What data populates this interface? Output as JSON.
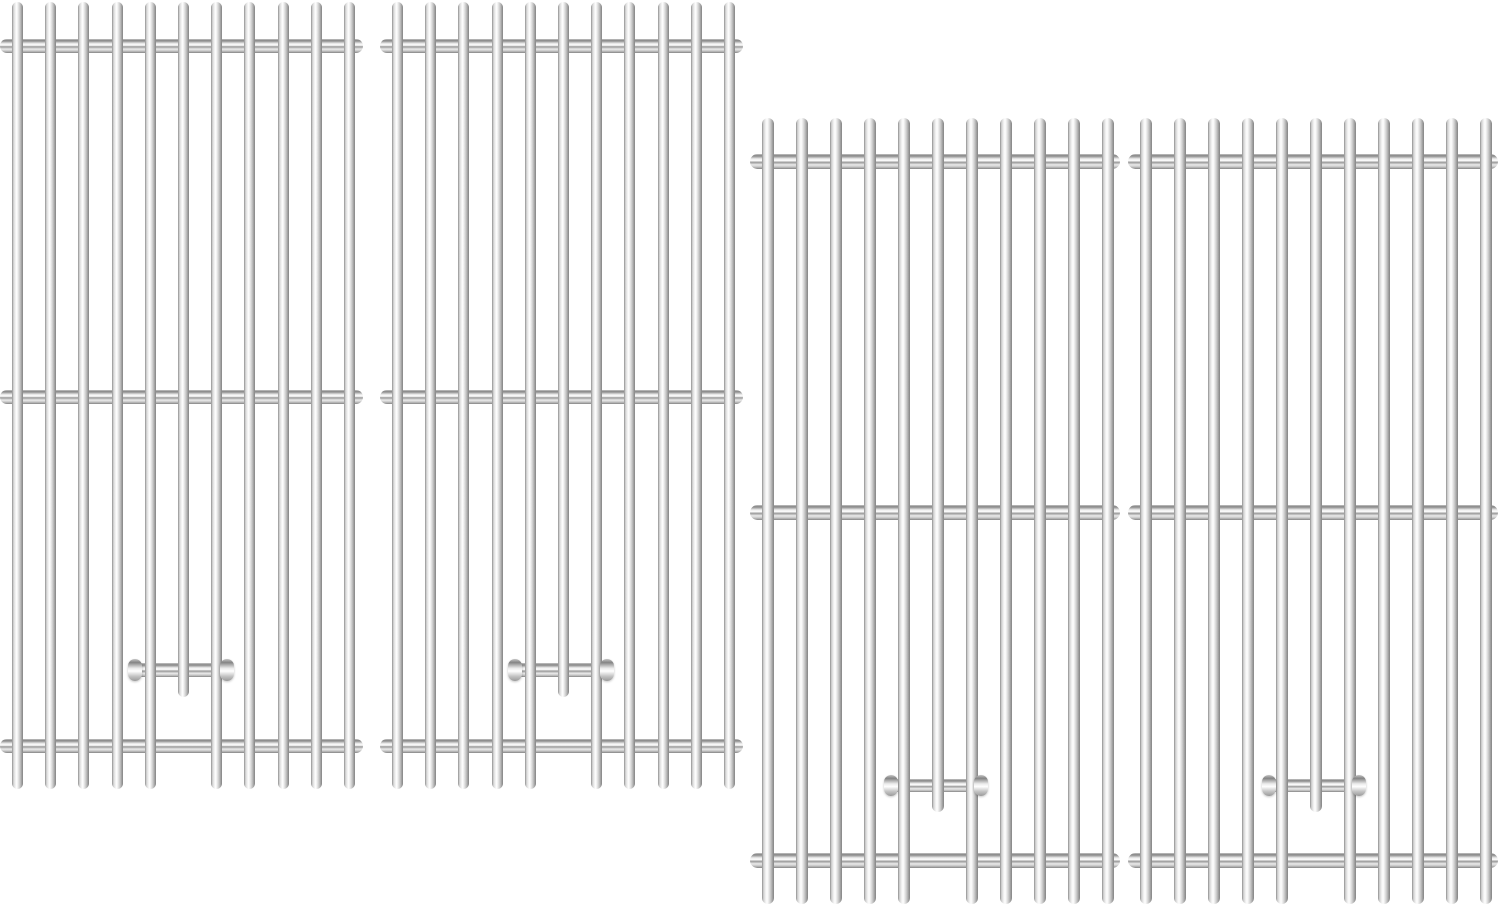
{
  "image": {
    "kind": "product-photo",
    "subject": "stainless-steel-grill-cooking-grates",
    "panel_count": 4,
    "rods_per_panel": 11,
    "support_rods_per_panel": 3,
    "brackets_per_panel": 1
  },
  "colors": {
    "background": "#ffffff",
    "metal_highlight": "#ffffff",
    "metal_light": "#ebebeb",
    "metal_mid": "#c4c4c4",
    "metal_dark": "#9a9a9a",
    "metal_edge": "#848484"
  },
  "panels": [
    {
      "x": 5,
      "y": 2,
      "barCount": 11,
      "barStart": 7,
      "barSpacing": 33.2,
      "barW": 11,
      "barH": 787,
      "shortIdx": 5,
      "shortH": 695,
      "crossbarYs": [
        37,
        388,
        737
      ],
      "cbH": 14,
      "cbX": -5,
      "cbW": 363,
      "bracket": {
        "x": 123,
        "w": 106,
        "rodY": 661,
        "rodH": 14,
        "capY": 657,
        "capH": 22,
        "capW": 14
      }
    },
    {
      "x": 385,
      "y": 2,
      "barCount": 11,
      "barStart": 7,
      "barSpacing": 33.2,
      "barW": 11,
      "barH": 787,
      "shortIdx": 5,
      "shortH": 695,
      "crossbarYs": [
        37,
        388,
        737
      ],
      "cbH": 14,
      "cbX": -5,
      "cbW": 363,
      "bracket": {
        "x": 123,
        "w": 106,
        "rodY": 661,
        "rodH": 14,
        "capY": 657,
        "capH": 22,
        "capW": 14
      }
    },
    {
      "x": 756,
      "y": 118,
      "barCount": 11,
      "barStart": 6,
      "barSpacing": 34,
      "barW": 12,
      "barH": 786,
      "shortIdx": 5,
      "shortH": 694,
      "crossbarYs": [
        36,
        387,
        735
      ],
      "cbH": 15,
      "cbX": -6,
      "cbW": 370,
      "bracket": {
        "x": 128,
        "w": 104,
        "rodY": 661,
        "rodH": 13,
        "capY": 657,
        "capH": 21,
        "capW": 14
      }
    },
    {
      "x": 1134,
      "y": 118,
      "barCount": 11,
      "barStart": 6,
      "barSpacing": 34,
      "barW": 12,
      "barH": 786,
      "shortIdx": 5,
      "shortH": 694,
      "crossbarYs": [
        36,
        387,
        735
      ],
      "cbH": 15,
      "cbX": -6,
      "cbW": 370,
      "bracket": {
        "x": 128,
        "w": 104,
        "rodY": 661,
        "rodH": 13,
        "capY": 657,
        "capH": 21,
        "capW": 14
      }
    }
  ]
}
